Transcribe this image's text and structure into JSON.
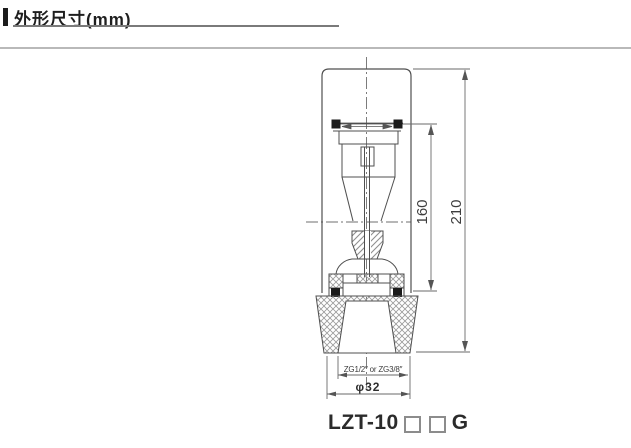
{
  "header": {
    "title": "外形尺寸(mm)"
  },
  "drawing": {
    "dims": {
      "tube_height": "160",
      "overall_height": "210",
      "thread": "ZG1/2″ or ZG3/8″",
      "diameter": "φ32"
    },
    "model": {
      "prefix": "LZT-10",
      "suffix": "G"
    }
  },
  "colors": {
    "line": "#4f4f4f",
    "dim_line": "#6a6a6a",
    "hatch": "#979797",
    "header_rule": "#b9b9b9",
    "title_underline": "#7a7a7a"
  }
}
